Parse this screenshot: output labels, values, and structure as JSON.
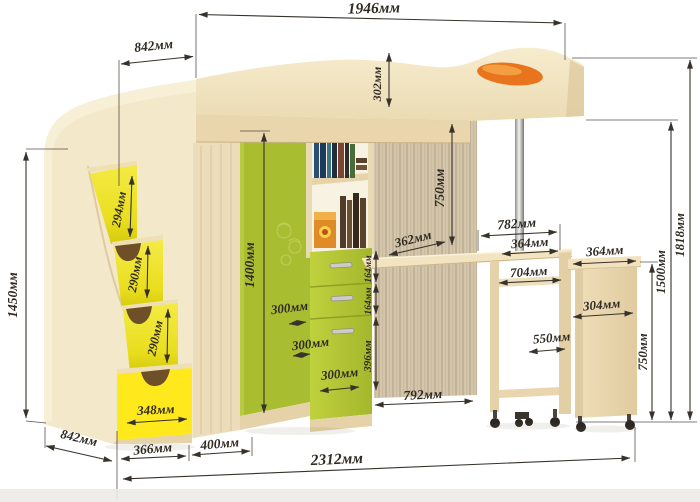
{
  "dimensions": {
    "bed_top_length": "1946мм",
    "upper_depth": "842мм",
    "bed_rail_height": "302мм",
    "ladder_height": "1450мм",
    "step_1": "294мм",
    "step_2": "290мм",
    "step_3": "290мм",
    "bottom_drawer": "348мм",
    "wardrobe_height": "1400мм",
    "corner_depth_1": "300мм",
    "corner_depth_2": "300мм",
    "corner_depth_3": "300мм",
    "shelf_drawer_1": "164мм",
    "shelf_drawer_2": "164мм",
    "lower_drawer": "396мм",
    "desktop_depth": "362мм",
    "under_bed_height": "750мм",
    "desk_length": "782мм",
    "desk_top_width": "364мм",
    "desk_shelf_width": "704мм",
    "desk_inner_depth": "550мм",
    "cabinet_top_width": "364мм",
    "cabinet_width": "304мм",
    "cabinet_height": "750мм",
    "bed_base_height": "1500мм",
    "total_height": "1818мм",
    "ladder_depth": "842мм",
    "ladder_width": "366мм",
    "wardrobe_front_width": "400мм",
    "under_bed_width": "792мм",
    "total_length": "2312мм"
  },
  "colors": {
    "wood_light": "#f3e7c9",
    "wood_medium": "#e8d5ae",
    "panel_texture": "#d3c6ac",
    "accent_green": "#a9bd31",
    "accent_green_bright": "#b9cb37",
    "accent_yellow": "#f2e93f",
    "accent_yellow_bright": "#ffe91c",
    "accent_orange": "#e8751d",
    "dimension_ink": "#2f2a22"
  }
}
